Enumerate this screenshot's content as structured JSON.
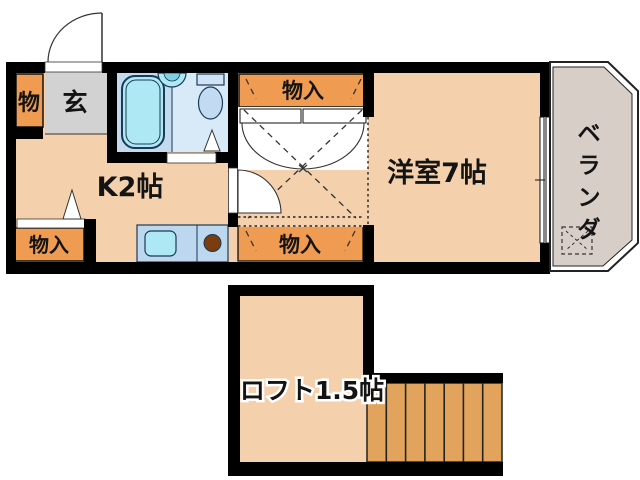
{
  "floorplan": {
    "type": "japanese-apartment-floorplan",
    "main_floor": {
      "entrance": {
        "label": "玄"
      },
      "entrance_closet": {
        "label": "物"
      },
      "kitchen": {
        "label": "K2帖"
      },
      "western_room": {
        "label": "洋室7帖"
      },
      "veranda": {
        "label": "ベランダ",
        "chars": [
          "ベ",
          "ラ",
          "ン",
          "ダ"
        ]
      },
      "storages": [
        {
          "label": "物入",
          "location": "kitchen-bottom-left"
        },
        {
          "label": "物入",
          "location": "center-top"
        },
        {
          "label": "物入",
          "location": "center-bottom"
        }
      ]
    },
    "loft_floor": {
      "loft": {
        "label": "ロフト1.5帖"
      },
      "stairs": {
        "treads": 7
      }
    },
    "colors": {
      "wall": "#000000",
      "room_floor": "#F4D0AC",
      "storage_orange": "#EF9B51",
      "stairs_orange": "#E2A45C",
      "entrance_gray": "#D2D2D2",
      "bathroom_blue": "#C4DAEF",
      "bathroom_blue_light": "#D8E9F8",
      "fixture_cyan": "#ADE8F4",
      "counter_blue": "#BDD7EE",
      "burner_brown": "#7B3D10",
      "veranda_gray": "#D7CFC7"
    }
  }
}
